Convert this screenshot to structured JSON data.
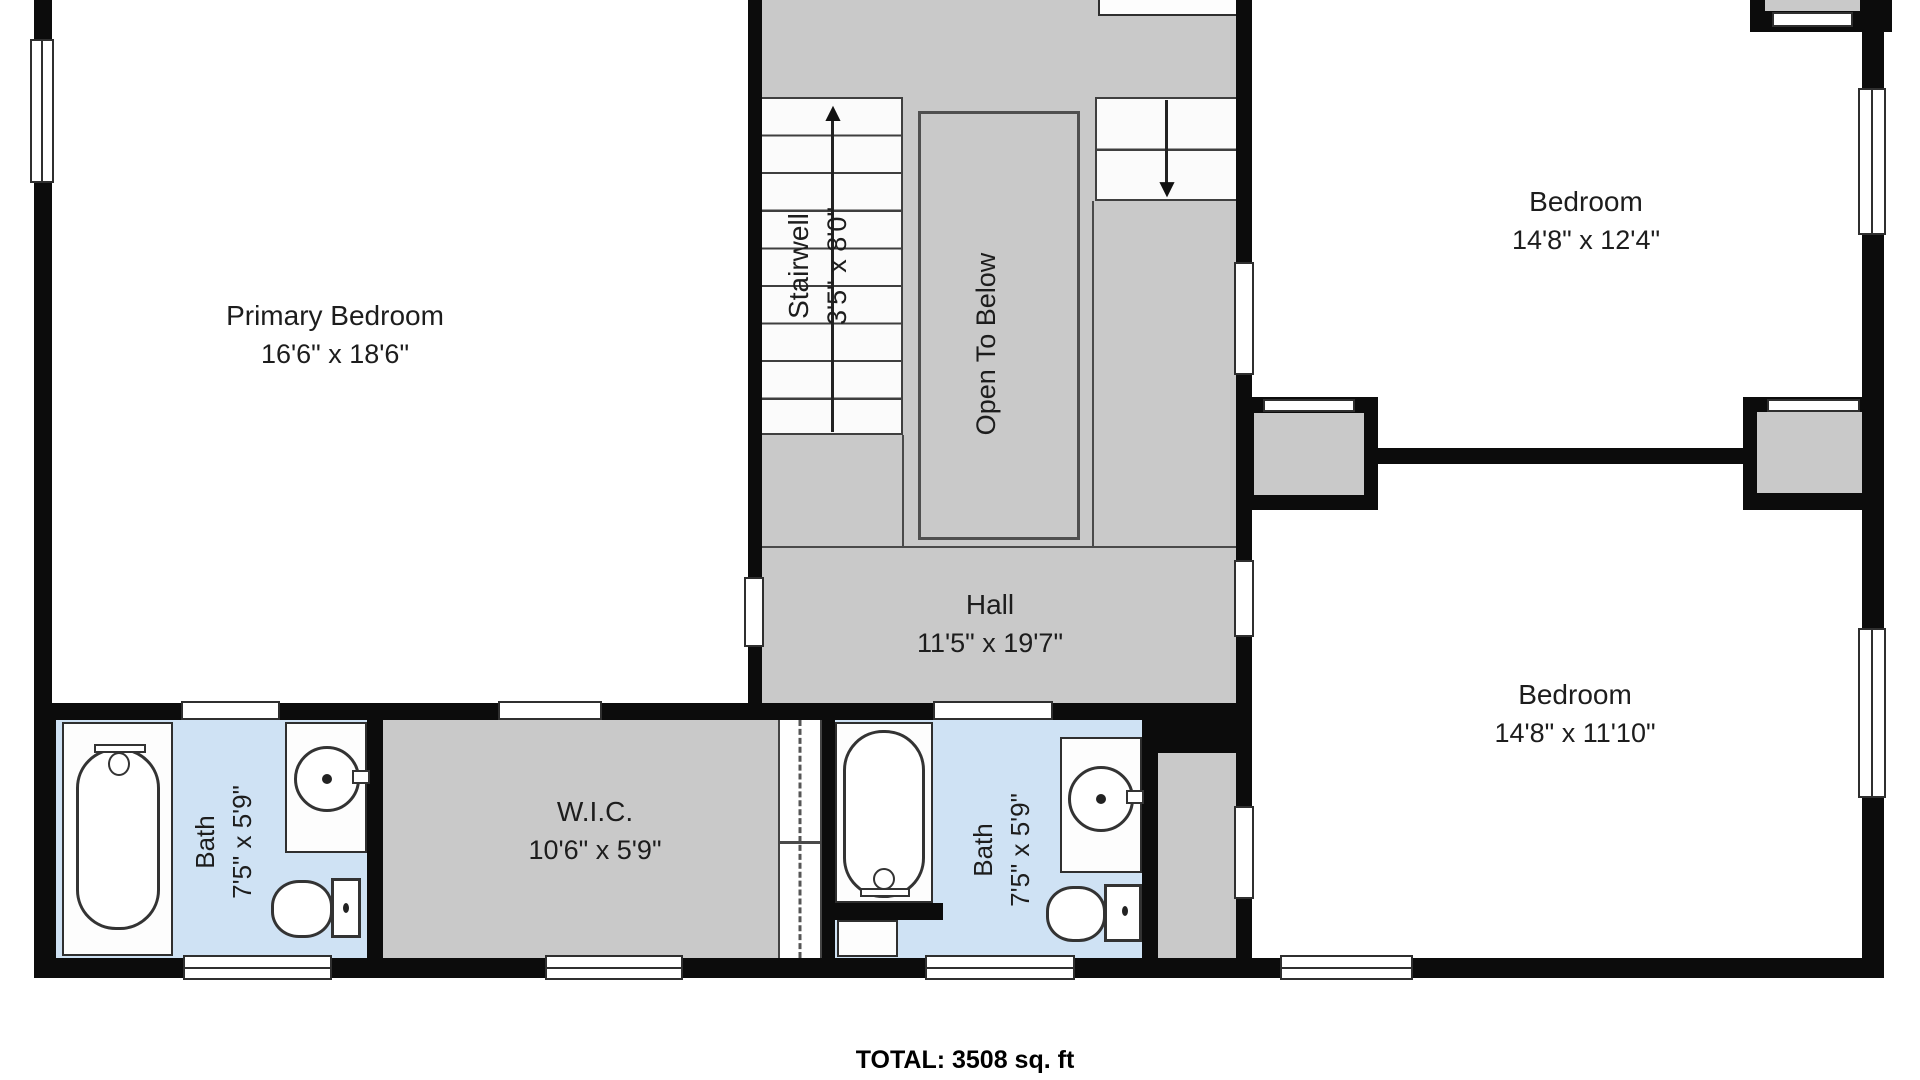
{
  "colors": {
    "wall": "#0c0c0c",
    "gray": "#c9c9c9",
    "blue": "#cfe2f4",
    "text": "#1d1d1d"
  },
  "icons": {
    "stairs_up_arrow": "▲",
    "stairs_down_arrow": "▼"
  },
  "rooms": {
    "primary_bedroom": {
      "name": "Primary Bedroom",
      "dims": "16'6\" x 18'6\""
    },
    "stairwell": {
      "name": "Stairwell",
      "dims": "3'5\" x 8'0\""
    },
    "open_to_below": {
      "name": "Open To Below"
    },
    "hall": {
      "name": "Hall",
      "dims": "11'5\" x 19'7\""
    },
    "bedroom_top_right": {
      "name": "Bedroom",
      "dims": "14'8\" x 12'4\""
    },
    "bedroom_bottom_right": {
      "name": "Bedroom",
      "dims": "14'8\" x 11'10\""
    },
    "bath_left": {
      "name": "Bath",
      "dims": "7'5\" x 5'9\""
    },
    "wic": {
      "name": "W.I.C.",
      "dims": "10'6\" x 5'9\""
    },
    "bath_right": {
      "name": "Bath",
      "dims": "7'5\" x 5'9\""
    }
  },
  "footer": {
    "total_label": "TOTAL: 3508 sq. ft"
  }
}
